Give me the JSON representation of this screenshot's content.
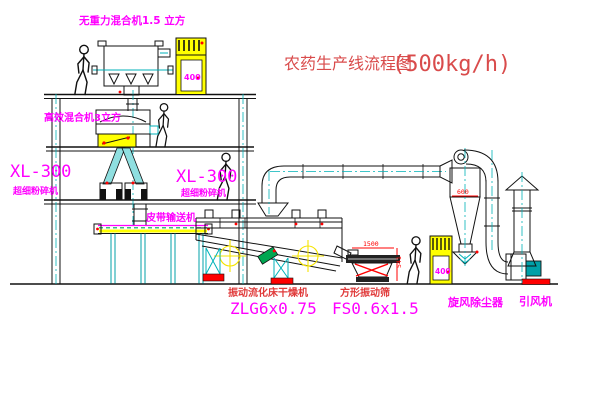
{
  "diagram": {
    "title": "农药生产线流程图",
    "capacity": "(500kg/h)"
  },
  "labels": {
    "gravityless_mixer": "无重力混合机1.5 立方",
    "high_efficiency_mixer": "高效混合机3立方",
    "mill_left_model": "XL-300",
    "mill_left_name": "超细粉碎机",
    "mill_center_model": "XL-300",
    "mill_center_name": "超细粉碎机",
    "belt_conveyor": "皮带输送机",
    "fluid_bed_dryer": "振动流化床干燥机",
    "fluid_bed_dryer_model": "ZLG6x0.75",
    "vibrating_sieve": "方形振动筛",
    "vibrating_sieve_model": "FS0.6x1.5",
    "cyclone": "旋风除尘器",
    "induced_draft_fan": "引风机"
  },
  "dimensions": {
    "cyclone_diameter": "600",
    "sieve_length": "1500",
    "sieve_height": "541"
  },
  "cabinets": {
    "upper_cabinet_text": "400",
    "lower_cabinet_text": "400"
  },
  "colors": {
    "line": "#111111",
    "cyan": "#00b2b8",
    "yellow": "#ffff00",
    "magenta": "#ff00ff",
    "red": "#ff0000",
    "title_red": "#d94b4b",
    "green": "#00a651"
  }
}
